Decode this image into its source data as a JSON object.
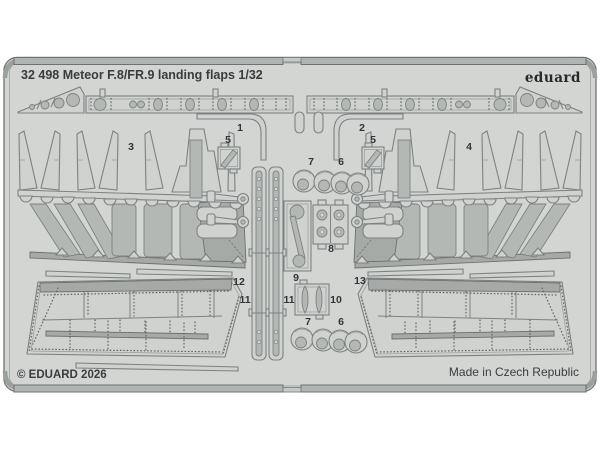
{
  "header": {
    "catalog_title": "32 498 Meteor F.8/FR.9 landing flaps 1/32",
    "brand_logo": "eduard"
  },
  "footer": {
    "copyright": "© EDUARD 2026",
    "made_in": "Made in Czech Republic"
  },
  "part_labels": [
    "1",
    "2",
    "3",
    "4",
    "5",
    "5",
    "7",
    "6",
    "8",
    "9",
    "10",
    "11",
    "11",
    "7",
    "6",
    "12",
    "13"
  ],
  "colors": {
    "background": "#ffffff",
    "fret_surface": "#d2d5d2",
    "part_outline": "#7d8281",
    "half_etch": "#b4b8b5",
    "dark_etch": "#a5aaa7",
    "frame_bar": "#b0b5b2",
    "text": "#3a3c3e"
  },
  "sheet": {
    "material": "photo-etch fret",
    "visible_part_numbers": [
      1,
      2,
      3,
      4,
      5,
      6,
      7,
      8,
      9,
      10,
      11,
      12,
      13
    ]
  }
}
